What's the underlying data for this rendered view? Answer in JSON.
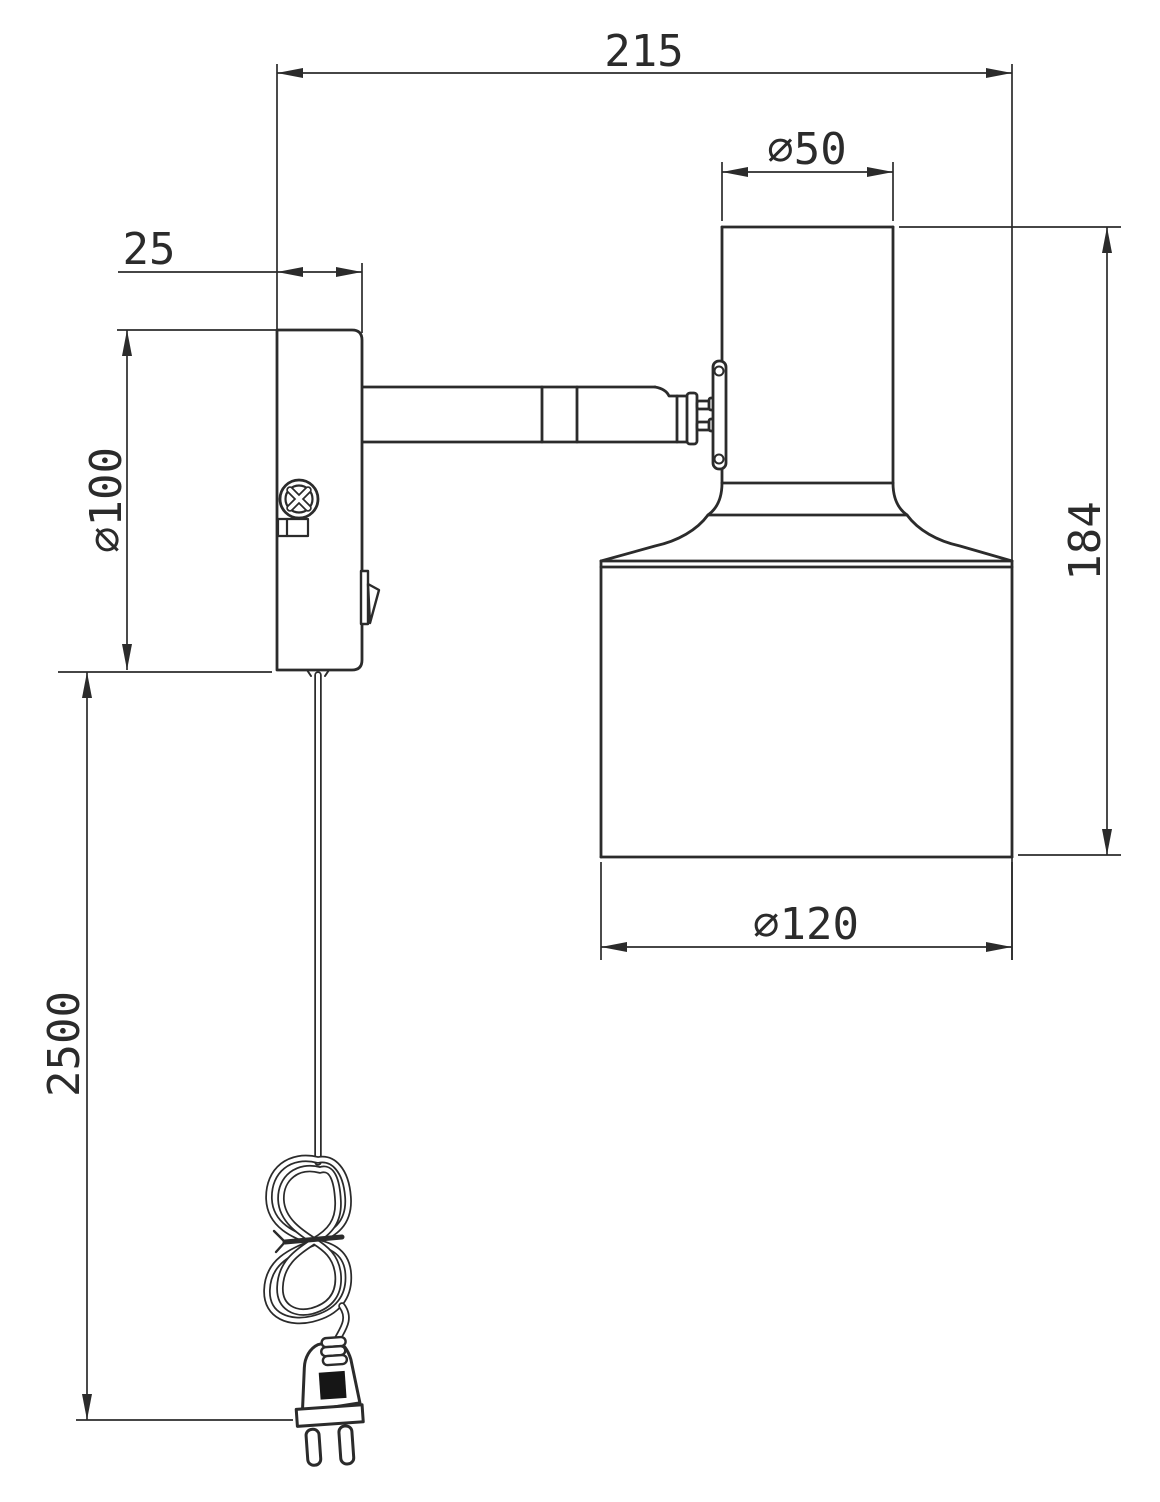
{
  "drawing": {
    "dimensions": {
      "overall_depth": "215",
      "head_diameter": "⌀50",
      "base_depth": "25",
      "base_diameter": "⌀100",
      "head_height": "184",
      "shade_diameter": "⌀120",
      "cable_length": "2500"
    },
    "colors": {
      "line": "#2b2b2b",
      "background": "#ffffff",
      "plug_label": "#161616"
    }
  }
}
